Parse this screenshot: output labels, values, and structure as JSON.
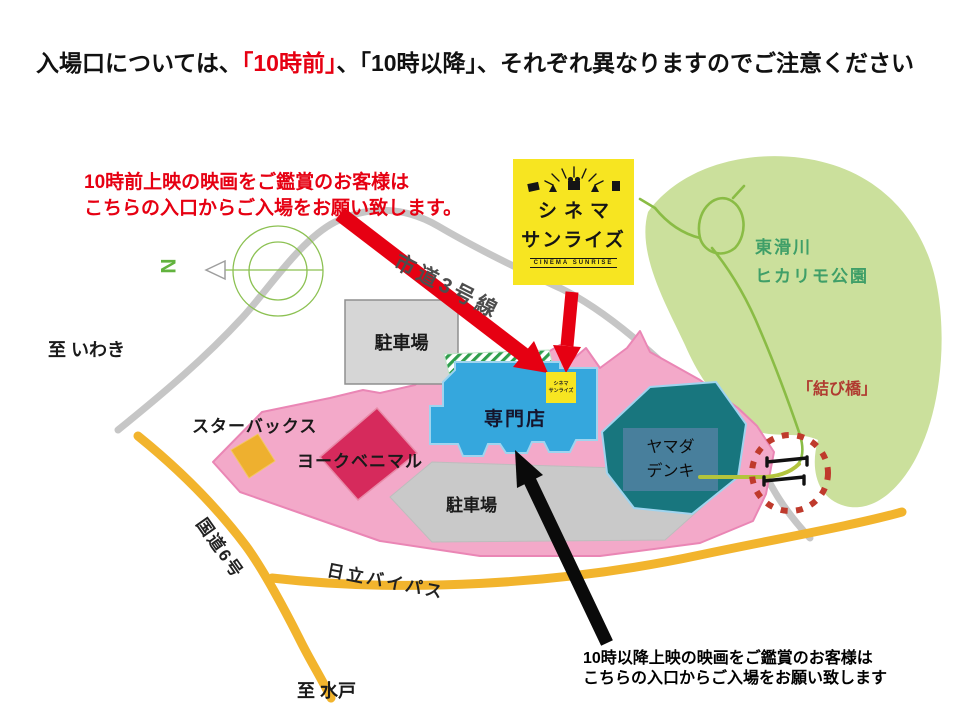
{
  "title": {
    "prefix": "入場口については、",
    "highlight": "「10時前」",
    "suffix": "、「10時以降」、それぞれ異なりますのでご注意ください"
  },
  "notes": {
    "before10_line1": "10時前上映の映画をご鑑賞のお客様は",
    "before10_line2": "こちらの入口からご入場をお願い致します。",
    "after10_line1": "10時以降上映の映画をご鑑賞のお客様は",
    "after10_line2": "こちらの入口からご入場をお願い致します"
  },
  "logo": {
    "line1": "シネマ",
    "line2": "サンライズ",
    "banner": "CINEMA SUNRISE"
  },
  "mini_logo": {
    "line1": "シネマ",
    "line2": "サンライズ"
  },
  "map": {
    "compass_n": "N",
    "park_line1": "東滑川",
    "park_line2": "ヒカリモ公園",
    "bridge": "「結び橋」",
    "road_city": "市道3号線",
    "road_national": "国道6号",
    "road_bypass": "日立バイパス",
    "to_iwaki": "至 いわき",
    "to_mito": "至 水戸",
    "parking_top": "駐車場",
    "parking_bottom": "駐車場",
    "specialty": "専門店",
    "starbucks": "スターバックス",
    "york_benimaru": "ヨークベニマル",
    "yamada_line1": "ヤマダ",
    "yamada_line2": "デンキ"
  },
  "colors": {
    "highlight_red": "#e60012",
    "arrow_red": "#e60012",
    "arrow_black": "#0a0a0a",
    "park_green": "#cbe09c",
    "trail_green": "#8abc45",
    "mall_pink": "#f3a9c9",
    "building_blue": "#35a7dd",
    "building_teal": "#18767e",
    "building_crimson": "#d62a5c",
    "starbucks_yellow": "#eeb02f",
    "road_yellow": "#f2b42d",
    "road_gray": "#c6c6c6",
    "parking_gray": "#d6d6d6",
    "logo_yellow": "#f7e521",
    "bridge_label_red": "#b03a30",
    "dashed_circle_red": "#bf3a2c",
    "crosswalk_green": "#2f9e4c"
  }
}
